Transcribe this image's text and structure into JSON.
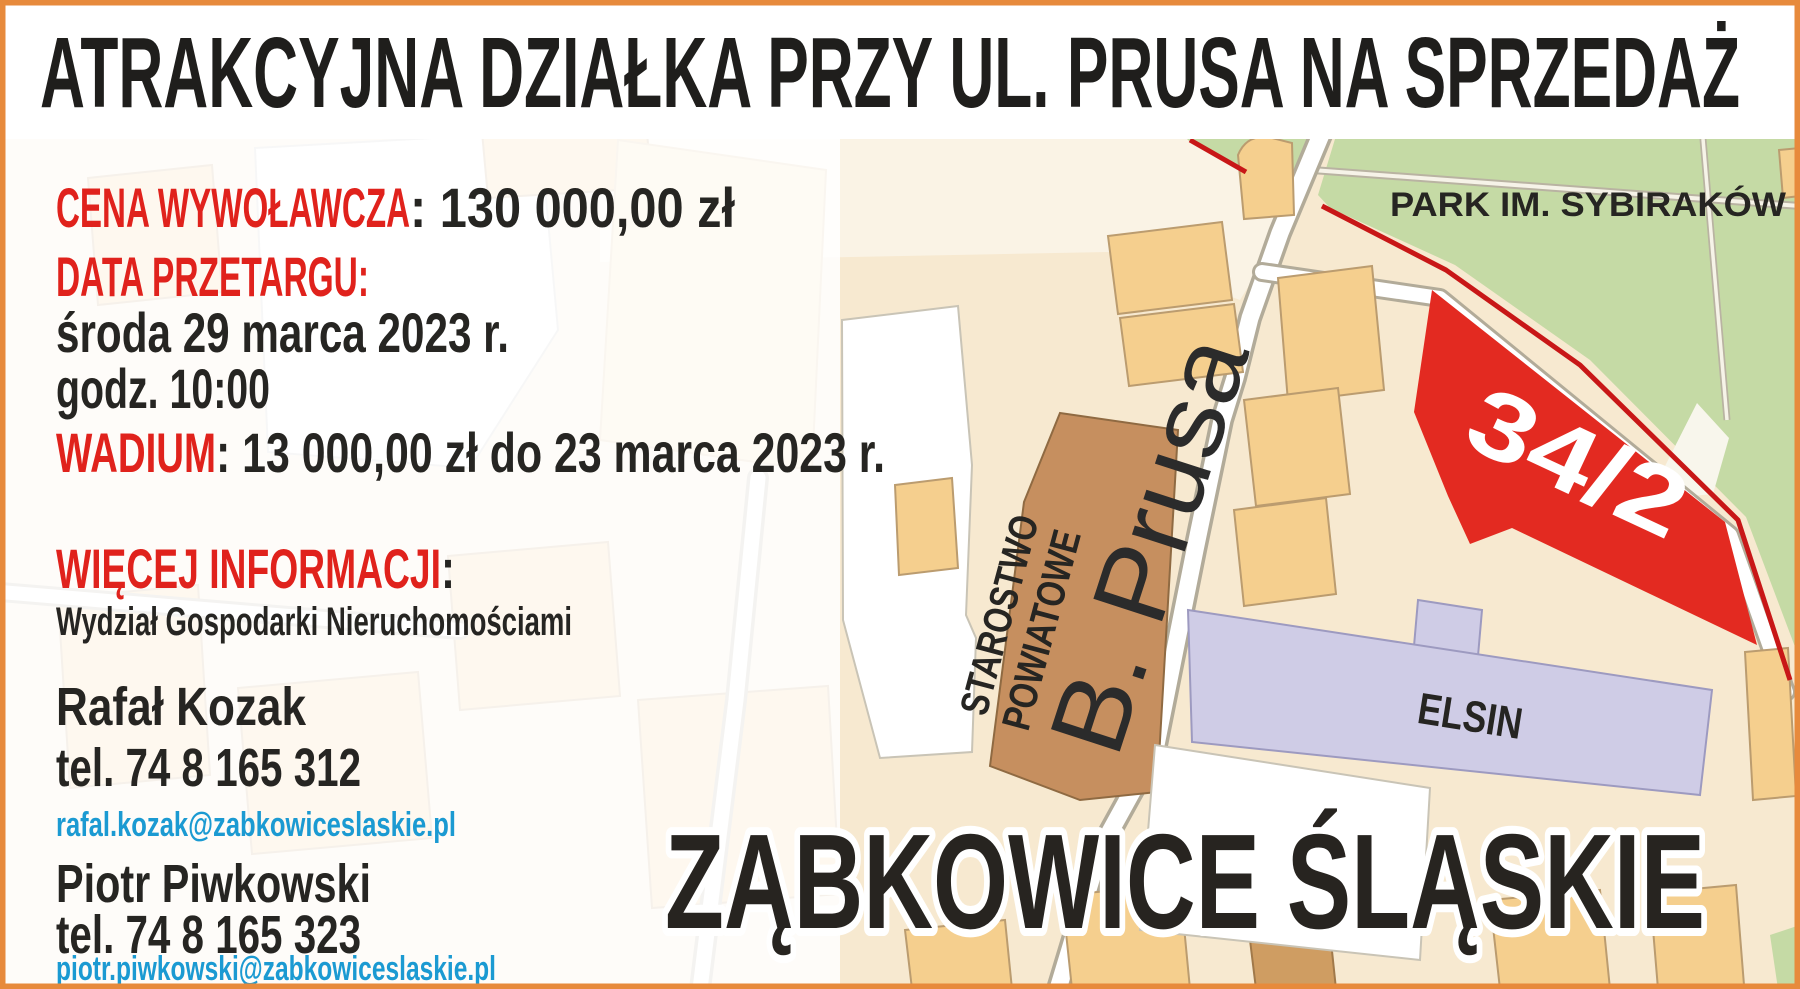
{
  "poster": {
    "title": "ATRAKCYJNA DZIAŁKA PRZY UL. PRUSA NA SPRZEDAŻ",
    "details": {
      "price_label": "CENA WYWOŁAWCZA",
      "price_value": ": 130 000,00 zł",
      "auction_label": "DATA PRZETARGU:",
      "auction_date": "środa 29 marca 2023 r.",
      "auction_time": "godz. 10:00",
      "wadium_label": "WADIUM",
      "wadium_value": ": 13 000,00 zł do 23 marca 2023 r."
    },
    "more_info": {
      "label": "WIĘCEJ INFORMACJI",
      "colon": ":",
      "department": "Wydział Gospodarki Nieruchomościami"
    },
    "contacts": [
      {
        "name": "Rafał Kozak",
        "phone": "tel. 74 8 165 312",
        "email": "rafal.kozak@zabkowiceslaskie.pl"
      },
      {
        "name": "Piotr Piwkowski",
        "phone": "tel. 74 8 165 323",
        "email": "piotr.piwkowski@zabkowiceslaskie.pl"
      }
    ]
  },
  "map": {
    "park_label": "PARK IM. SYBIRAKÓW",
    "parcel_label": "34/2",
    "street_label": "B. Prusa",
    "starostwo_line1": "STAROSTWO",
    "starostwo_line2": "POWIATOWE",
    "elsin_label": "ELSIN",
    "city_label": "ZĄBKOWICE ŚLĄSKIE"
  },
  "colors": {
    "accent_red": "#e0221c",
    "parcel_red": "#e32a21",
    "boundary_red": "#c81717",
    "park_green": "#c5daa5",
    "map_beige": "#f7e9d0",
    "building_tan": "#f5cf8e",
    "building_brown": "#c68f5f",
    "building_lavender": "#cfcce6",
    "email_blue": "#1b9ad2",
    "border_orange": "#e78a3c",
    "text_dark": "#262522"
  }
}
